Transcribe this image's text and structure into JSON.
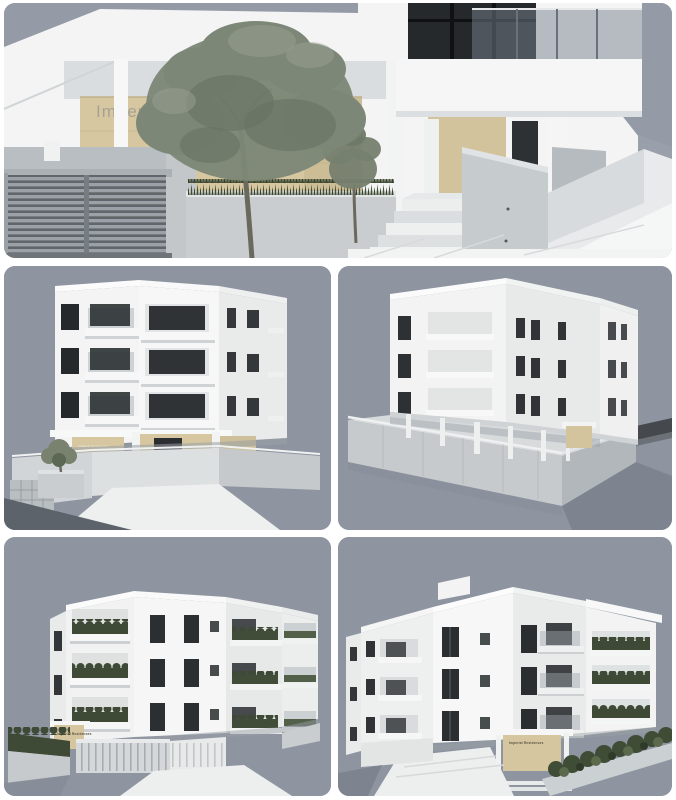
{
  "gallery": {
    "panels": [
      {
        "id": "entrance-closeup",
        "description": "3D render: street entrance with olive tree, louvered gate, stairs and signage wall",
        "sign_text": "Imperial Resi"
      },
      {
        "id": "front-left-view",
        "description": "3D render: white three-storey apartment building, front-left perspective",
        "sign_text": "Imperial Residences"
      },
      {
        "id": "rear-corner-view",
        "description": "3D render: rear corner view of building raised on columns over concrete retaining wall"
      },
      {
        "id": "landscaped-left-view",
        "description": "3D render: building with planted balconies, front-left view",
        "sign_text": "Imperial Residences"
      },
      {
        "id": "landscaped-right-view",
        "description": "3D render: building with planted balconies, front-right view",
        "sign_text": "Imperial Residences"
      }
    ],
    "colors": {
      "canvas": "#ffffff",
      "sky": "#949ba7",
      "render_background": "#8e95a1",
      "building_white": "#f4f5f3",
      "building_shade": "#e9ebea",
      "beige_stone": "#d6c7a0",
      "concrete": "#c6cacd",
      "window_glass_dark": "#2b2e30",
      "balustrade_glass": "#99a1a8",
      "foliage": "#7d8777",
      "hedge_green": "#3e4a36"
    }
  }
}
